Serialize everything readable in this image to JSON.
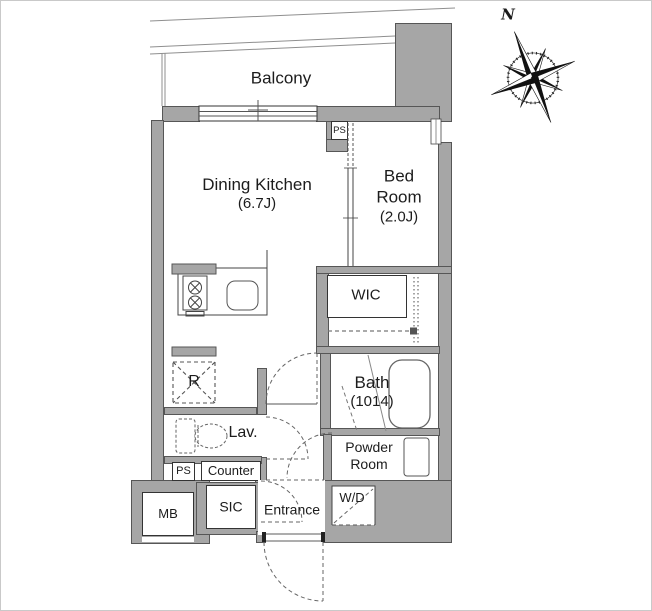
{
  "rooms": {
    "balcony": {
      "label": "Balcony"
    },
    "dining_kitchen": {
      "name": "Dining Kitchen",
      "size": "(6.7J)"
    },
    "bed_room": {
      "line1": "Bed",
      "line2": "Room",
      "size": "(2.0J)"
    },
    "wic": {
      "label": "WIC"
    },
    "bath": {
      "name": "Bath",
      "size": "(1014)"
    },
    "powder_room": {
      "line1": "Powder",
      "line2": "Room"
    },
    "lavatory": {
      "label": "Lav."
    },
    "entrance": {
      "label": "Entrance"
    },
    "shoes_closet": {
      "label": "SIC"
    }
  },
  "labels": {
    "washer_dryer": "W/D",
    "meter_box": "MB",
    "refrigerator": "R",
    "kitchen_counter": "Counter",
    "pipe_space_top": "PS",
    "pipe_space_bottom": "PS",
    "compass_north": "N"
  },
  "colors": {
    "wall": "#a6a6a6",
    "wall_edge": "#565656",
    "line": "#333333",
    "dash": "#666666",
    "background": "#ffffff"
  }
}
